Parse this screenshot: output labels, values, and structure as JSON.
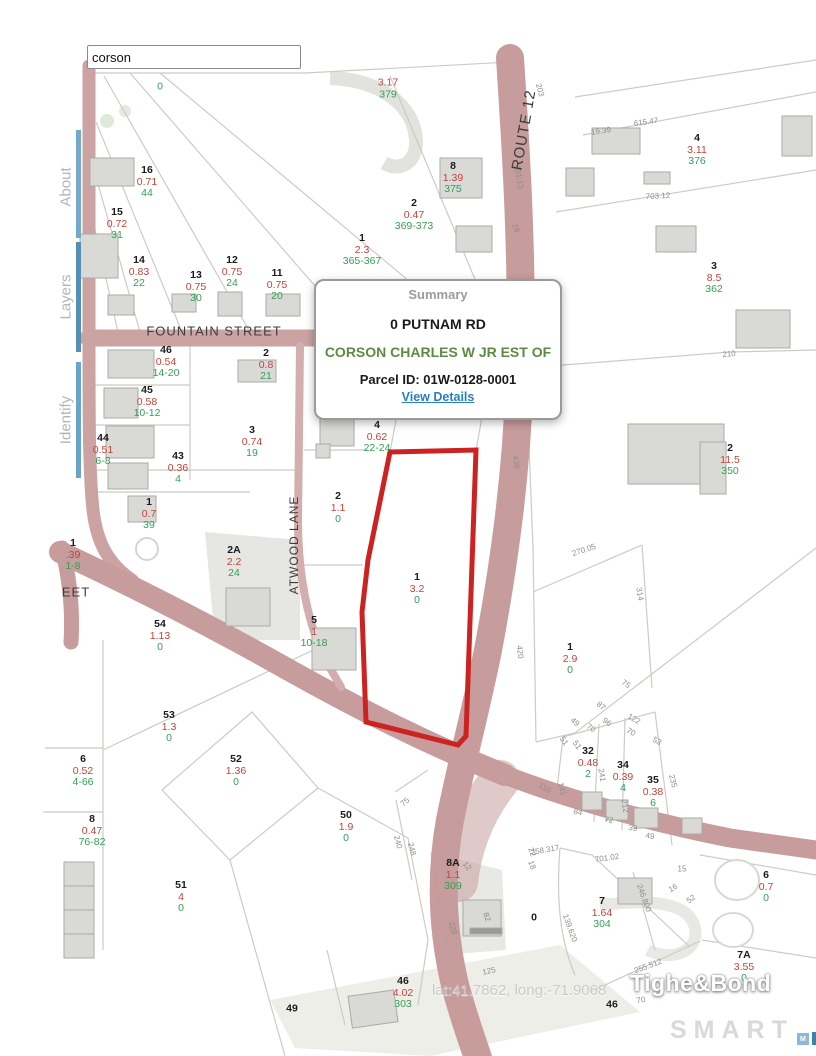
{
  "search": {
    "value": "corson"
  },
  "sidebar": {
    "tabs": [
      {
        "label": "About"
      },
      {
        "label": "Layers"
      },
      {
        "label": "Identify"
      }
    ]
  },
  "popup": {
    "title": "Summary",
    "address": "0 PUTNAM RD",
    "owner": "CORSON CHARLES W JR EST OF",
    "parcel_id": "Parcel ID: 01W-0128-0001",
    "link_label": "View Details"
  },
  "watermarks": {
    "latlong": "lat:41.7862, long:-71.9068",
    "brand": "Tighe&Bond",
    "logo_word": "SMART",
    "logo_blocks": [
      "M",
      "L",
      "S"
    ]
  },
  "map": {
    "colors": {
      "road": "#c79e9e",
      "parcel_line": "#ccccc4",
      "building": "#d9d9d6",
      "selected_outline": "#cc2222",
      "lot_number": "#1c1c1c",
      "acreage": "#c4433b",
      "address": "#33a055",
      "owner_green": "#5e8a43",
      "link_blue": "#2a7fbf"
    },
    "street_labels": [
      {
        "text": "FOUNTAIN STREET",
        "x": 214,
        "y": 331,
        "r": 0,
        "size": 13
      },
      {
        "text": "ATWOOD LANE",
        "x": 294,
        "y": 545,
        "r": -90,
        "size": 12
      },
      {
        "text": "ROUTE 12",
        "x": 524,
        "y": 130,
        "r": -80,
        "size": 15
      },
      {
        "text": "EET",
        "x": 76,
        "y": 592,
        "r": 0,
        "size": 13
      }
    ],
    "parcel_labels": [
      {
        "ad": "0",
        "x": 160,
        "y": 88
      },
      {
        "ac": "3.17",
        "ad": "379",
        "x": 388,
        "y": 90
      },
      {
        "lot": "16",
        "ac": "0.71",
        "ad": "44",
        "x": 147,
        "y": 184
      },
      {
        "lot": "15",
        "ac": "0.72",
        "ad": "31",
        "x": 117,
        "y": 226
      },
      {
        "lot": "14",
        "ac": "0.83",
        "ad": "22",
        "x": 139,
        "y": 274
      },
      {
        "lot": "13",
        "ac": "0.75",
        "ad": "30",
        "x": 196,
        "y": 289
      },
      {
        "lot": "12",
        "ac": "0.75",
        "ad": "24",
        "x": 232,
        "y": 274
      },
      {
        "lot": "11",
        "ac": "0.75",
        "ad": "20",
        "x": 277,
        "y": 287
      },
      {
        "lot": "8",
        "ac": "1.39",
        "ad": "375",
        "x": 453,
        "y": 180
      },
      {
        "lot": "2",
        "ac": "0.47",
        "ad": "369-373",
        "x": 414,
        "y": 217
      },
      {
        "lot": "1",
        "ac": "2.3",
        "ad": "365-367",
        "x": 362,
        "y": 252
      },
      {
        "lot": "4",
        "ac": "3.11",
        "ad": "376",
        "x": 697,
        "y": 152
      },
      {
        "lot": "3",
        "ac": "8.5",
        "ad": "362",
        "x": 714,
        "y": 280
      },
      {
        "lot": "2",
        "ac": "11.5",
        "ad": "350",
        "x": 730,
        "y": 462
      },
      {
        "lot": "46",
        "ac": "0.54",
        "ad": "14-20",
        "x": 166,
        "y": 364
      },
      {
        "lot": "2",
        "ac": "0.8",
        "ad": "21",
        "x": 266,
        "y": 367
      },
      {
        "lot": "45",
        "ac": "0.58",
        "ad": "10-12",
        "x": 147,
        "y": 404
      },
      {
        "lot": "44",
        "ac": "0.51",
        "ad": "6-8",
        "x": 103,
        "y": 452
      },
      {
        "lot": "3",
        "ac": "0.74",
        "ad": "19",
        "x": 252,
        "y": 444
      },
      {
        "lot": "43",
        "ac": "0.36",
        "ad": "4",
        "x": 178,
        "y": 470
      },
      {
        "lot": "1",
        "ac": "0.7",
        "ad": "39",
        "x": 149,
        "y": 516
      },
      {
        "lot": "4",
        "ac": "0.62",
        "ad": "22-24",
        "x": 377,
        "y": 439
      },
      {
        "lot": "2",
        "ac": "1.1",
        "ad": "0",
        "x": 338,
        "y": 510
      },
      {
        "lot": "1",
        "ac": "3.2",
        "ad": "0",
        "x": 417,
        "y": 591
      },
      {
        "lot": "5",
        "ac": "1",
        "ad": "10-18",
        "x": 314,
        "y": 634
      },
      {
        "lot": "1",
        "ac": ".39",
        "ad": "1-8",
        "x": 73,
        "y": 557
      },
      {
        "lot": "2A",
        "ac": "2.2",
        "ad": "24",
        "x": 234,
        "y": 564
      },
      {
        "lot": "54",
        "ac": "1.13",
        "ad": "0",
        "x": 160,
        "y": 638
      },
      {
        "lot": "53",
        "ac": "1.3",
        "ad": "0",
        "x": 169,
        "y": 729
      },
      {
        "lot": "6",
        "ac": "0.52",
        "ad": "4-66",
        "x": 83,
        "y": 773
      },
      {
        "lot": "52",
        "ac": "1.36",
        "ad": "0",
        "x": 236,
        "y": 773
      },
      {
        "lot": "8",
        "ac": "0.47",
        "ad": "76-82",
        "x": 92,
        "y": 833
      },
      {
        "lot": "51",
        "ac": "4",
        "ad": "0",
        "x": 181,
        "y": 899
      },
      {
        "lot": "50",
        "ac": "1.9",
        "ad": "0",
        "x": 346,
        "y": 829
      },
      {
        "lot": "1",
        "ac": "2.9",
        "ad": "0",
        "x": 570,
        "y": 661
      },
      {
        "lot": "32",
        "ac": "0.48",
        "ad": "2",
        "x": 588,
        "y": 765
      },
      {
        "lot": "34",
        "ac": "0.39",
        "ad": "4",
        "x": 623,
        "y": 779
      },
      {
        "lot": "35",
        "ac": "0.38",
        "ad": "6",
        "x": 653,
        "y": 794
      },
      {
        "lot": "8A",
        "ac": "1.1",
        "ad": "309",
        "x": 453,
        "y": 877
      },
      {
        "lot": "0",
        "x": 534,
        "y": 919
      },
      {
        "lot": "7",
        "ac": "1.64",
        "ad": "304",
        "x": 602,
        "y": 915
      },
      {
        "lot": "6",
        "ac": "0.7",
        "ad": "0",
        "x": 766,
        "y": 889
      },
      {
        "lot": "7A",
        "ac": "3.55",
        "ad": "0",
        "x": 744,
        "y": 969
      },
      {
        "lot": "46",
        "ac": "4.02",
        "ad": "303",
        "x": 403,
        "y": 995
      },
      {
        "lot": "49",
        "x": 292,
        "y": 1010
      },
      {
        "lot": "46",
        "x": 612,
        "y": 1006
      }
    ],
    "dimension_labels": [
      {
        "t": "203",
        "x": 540,
        "y": 90,
        "r": 75
      },
      {
        "t": "19.39",
        "x": 601,
        "y": 131,
        "r": -8
      },
      {
        "t": "615.47",
        "x": 646,
        "y": 122,
        "r": -8
      },
      {
        "t": "703.12",
        "x": 658,
        "y": 196,
        "r": -3
      },
      {
        "t": "201.13",
        "x": 519,
        "y": 177,
        "r": 80
      },
      {
        "t": "19",
        "x": 516,
        "y": 228,
        "r": 75
      },
      {
        "t": "210",
        "x": 729,
        "y": 354,
        "r": -5
      },
      {
        "t": "438",
        "x": 516,
        "y": 462,
        "r": 82
      },
      {
        "t": "270.05",
        "x": 584,
        "y": 550,
        "r": -18
      },
      {
        "t": "314",
        "x": 640,
        "y": 594,
        "r": 80
      },
      {
        "t": "420",
        "x": 520,
        "y": 652,
        "r": 85
      },
      {
        "t": "75",
        "x": 626,
        "y": 684,
        "r": 35
      },
      {
        "t": "87",
        "x": 601,
        "y": 706,
        "r": 40
      },
      {
        "t": "49",
        "x": 575,
        "y": 722,
        "r": 40
      },
      {
        "t": "70",
        "x": 591,
        "y": 728,
        "r": 35
      },
      {
        "t": "96",
        "x": 607,
        "y": 722,
        "r": 35
      },
      {
        "t": "122",
        "x": 634,
        "y": 719,
        "r": 30
      },
      {
        "t": "70",
        "x": 631,
        "y": 732,
        "r": 30
      },
      {
        "t": "53",
        "x": 657,
        "y": 741,
        "r": 30
      },
      {
        "t": "51",
        "x": 564,
        "y": 741,
        "r": 55
      },
      {
        "t": "51",
        "x": 577,
        "y": 745,
        "r": 55
      },
      {
        "t": "141",
        "x": 562,
        "y": 789,
        "r": 75
      },
      {
        "t": "110",
        "x": 545,
        "y": 788,
        "r": 30
      },
      {
        "t": "241",
        "x": 602,
        "y": 775,
        "r": 80
      },
      {
        "t": "212",
        "x": 625,
        "y": 806,
        "r": 80
      },
      {
        "t": "235",
        "x": 673,
        "y": 781,
        "r": 75
      },
      {
        "t": "84",
        "x": 578,
        "y": 812,
        "r": 10
      },
      {
        "t": "72",
        "x": 609,
        "y": 820,
        "r": 10
      },
      {
        "t": "39",
        "x": 633,
        "y": 828,
        "r": 10
      },
      {
        "t": "49",
        "x": 650,
        "y": 836,
        "r": 10
      },
      {
        "t": "258.317",
        "x": 545,
        "y": 850,
        "r": -10
      },
      {
        "t": "701.02",
        "x": 607,
        "y": 858,
        "r": -8
      },
      {
        "t": "22",
        "x": 532,
        "y": 852,
        "r": 70
      },
      {
        "t": "18",
        "x": 532,
        "y": 865,
        "r": 70
      },
      {
        "t": "12",
        "x": 467,
        "y": 866,
        "r": 50
      },
      {
        "t": "248",
        "x": 412,
        "y": 849,
        "r": 75
      },
      {
        "t": "229",
        "x": 453,
        "y": 928,
        "r": 75
      },
      {
        "t": "82",
        "x": 487,
        "y": 917,
        "r": 70
      },
      {
        "t": "125",
        "x": 489,
        "y": 971,
        "r": -12
      },
      {
        "t": "15",
        "x": 682,
        "y": 869,
        "r": 0
      },
      {
        "t": "16",
        "x": 673,
        "y": 888,
        "r": -30
      },
      {
        "t": "52",
        "x": 691,
        "y": 899,
        "r": -35
      },
      {
        "t": "246.800",
        "x": 644,
        "y": 898,
        "r": 70
      },
      {
        "t": "139.620",
        "x": 570,
        "y": 928,
        "r": 70
      },
      {
        "t": "255.512",
        "x": 648,
        "y": 966,
        "r": -20
      },
      {
        "t": "70",
        "x": 641,
        "y": 1000,
        "r": -10
      },
      {
        "t": "75",
        "x": 405,
        "y": 802,
        "r": -40
      },
      {
        "t": "240",
        "x": 398,
        "y": 842,
        "r": 75
      }
    ]
  }
}
